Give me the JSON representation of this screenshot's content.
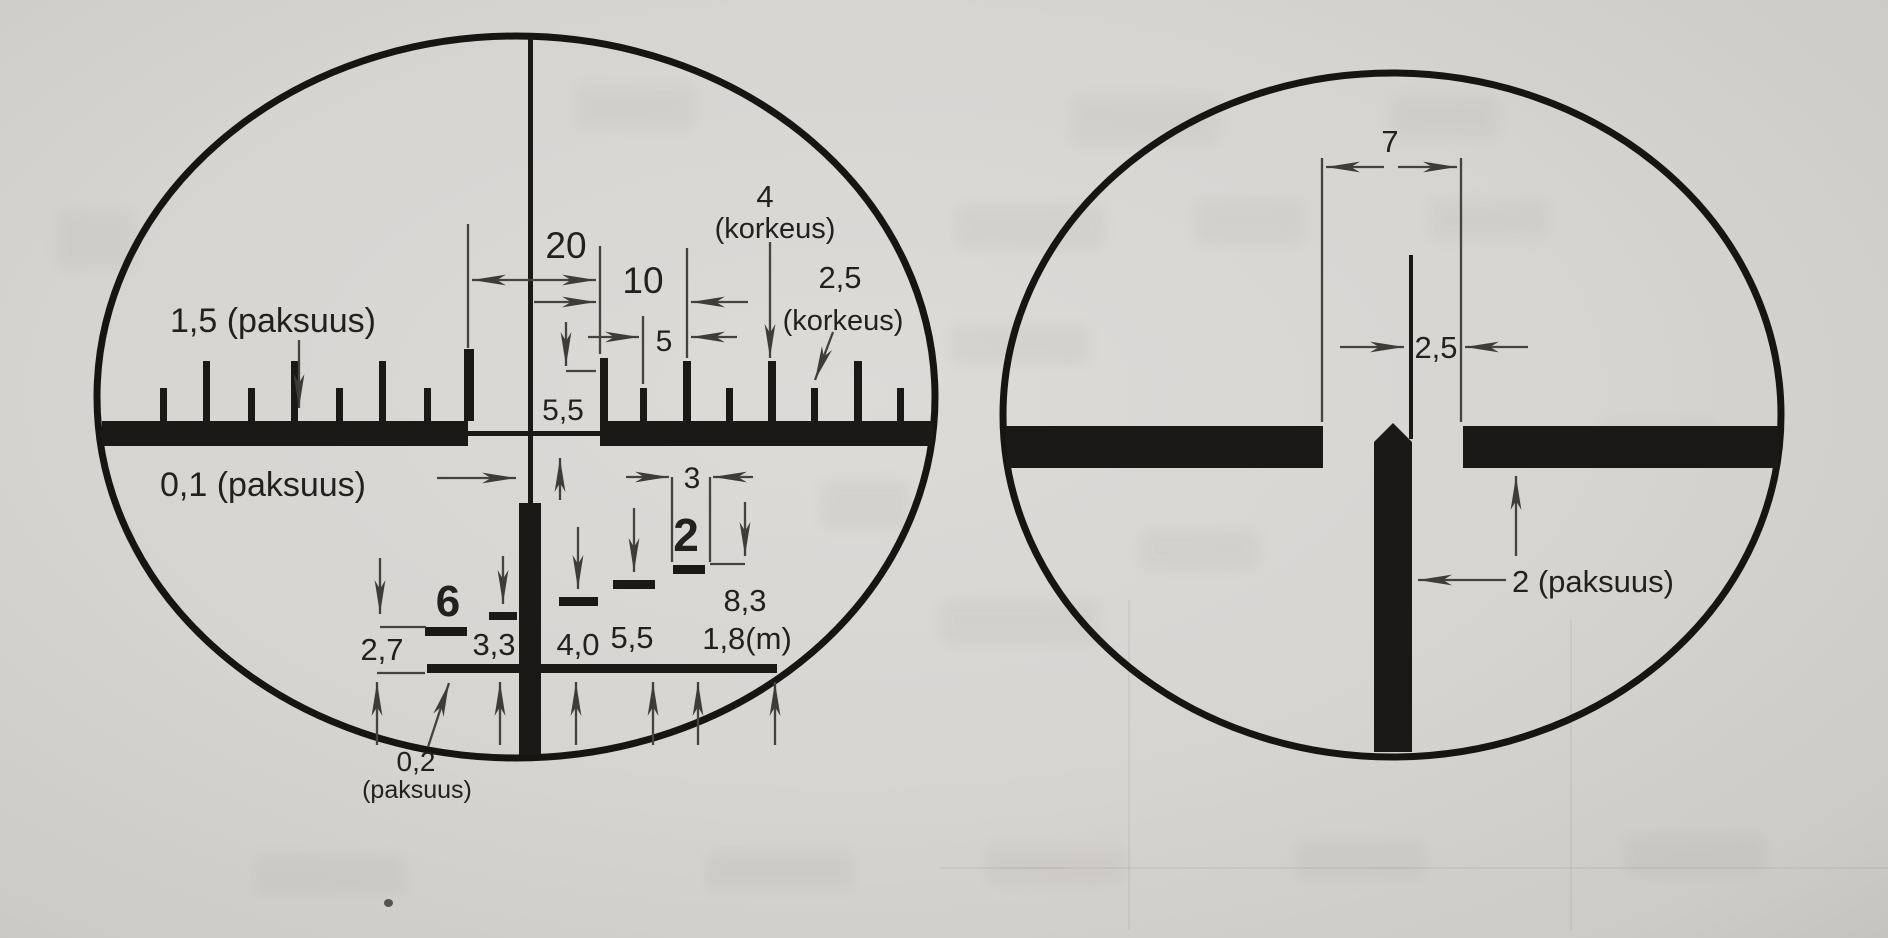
{
  "colors": {
    "ink": "#1b1918",
    "paper": "#d7d5d2",
    "dimension_lines": "#454340"
  },
  "left_reticle": {
    "labels": {
      "thickness_1_5": "1,5 (paksuus)",
      "dim_20": "20",
      "dim_10": "10",
      "dim_5": "5",
      "tick_height_5_5": "5,5",
      "height_4": "4",
      "height_4_unit": "(korkeus)",
      "height_2_5": "2,5",
      "height_2_5_unit": "(korkeus)",
      "thickness_0_1": "0,1 (paksuus)",
      "dim_3": "3",
      "stadia_2": "2",
      "range_8_3": "8,3",
      "target_height_1_8": "1,8(m)",
      "stadia_6": "6",
      "dim_3_3": "3,3",
      "dim_4_0": "4,0",
      "dim_5_5": "5,5",
      "dim_2_7": "2,7",
      "thickness_0_2": "0,2",
      "thickness_0_2_unit": "(paksuus)"
    }
  },
  "right_reticle": {
    "labels": {
      "gap_7": "7",
      "tip_width_2_5": "2,5",
      "thickness_2": "2 (paksuus)"
    }
  }
}
